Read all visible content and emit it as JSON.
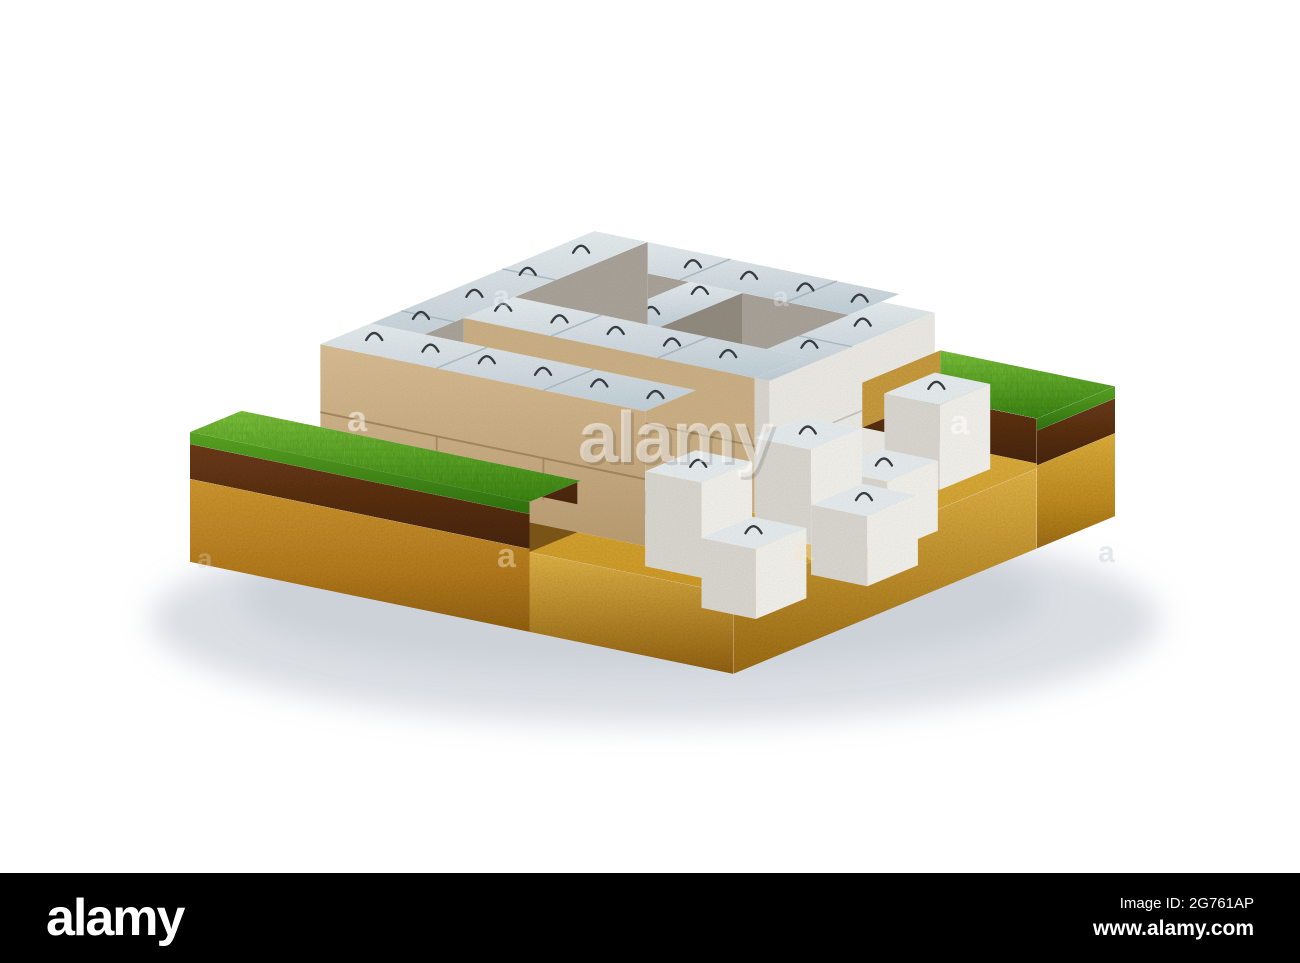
{
  "alt": "3D render of precast concrete foundation blocks with wire lifting loops assembled into foundation walls, standing in an excavated trench on an isometric cutaway block of ground showing grass, topsoil and sandy soil layers, on a white background",
  "watermark": {
    "brand": "alamy",
    "tile_char": "a"
  },
  "footer": {
    "logo": "alamy",
    "image_id": "Image ID: 2G761AP",
    "website": "www.alamy.com"
  },
  "colors": {
    "bg": "#ffffff",
    "shadow": "#a9b3be",
    "trench_hi": "#e3b84a",
    "trench_lo": "#cd9a26",
    "channel_dirt": "#372511",
    "cell_dirt": "#54371a",
    "sand_left_hi": "#cd9630",
    "sand_left_lo": "#8f5f10",
    "sand_right_hi": "#dcae3c",
    "sand_right_lo": "#9a6a12",
    "cut_hi": "#dfb245",
    "step_soil": "#7a5317",
    "topsoil_hi": "#6b3a16",
    "topsoil_lo": "#46240c",
    "grass_hi": "#82cc3e",
    "grass_lo": "#3e8c12",
    "grass_edge_hi": "#57a021",
    "grass_edge_lo": "#2e6e0e",
    "block_top_hi": "#e3e9eb",
    "block_top_lo": "#bfccd4",
    "block_tan": "#d6ba92",
    "block_tan_lo": "#b89b70",
    "wa2_tan": "#c9ae84",
    "block_inner": "#a7a198",
    "block_inner_dark": "#90897e",
    "block_end_light": "#e9e7e1",
    "block_step_face": "#d7d4cd",
    "block_step_end": "#efede8",
    "joint_tan": "#9c805a",
    "joint_top": "#9fafb9",
    "joint_gray": "#8d867c",
    "loop": "#363c42",
    "watermark_text": "#ffffff",
    "footer_bg": "#000000",
    "footer_text": "#ffffff"
  }
}
